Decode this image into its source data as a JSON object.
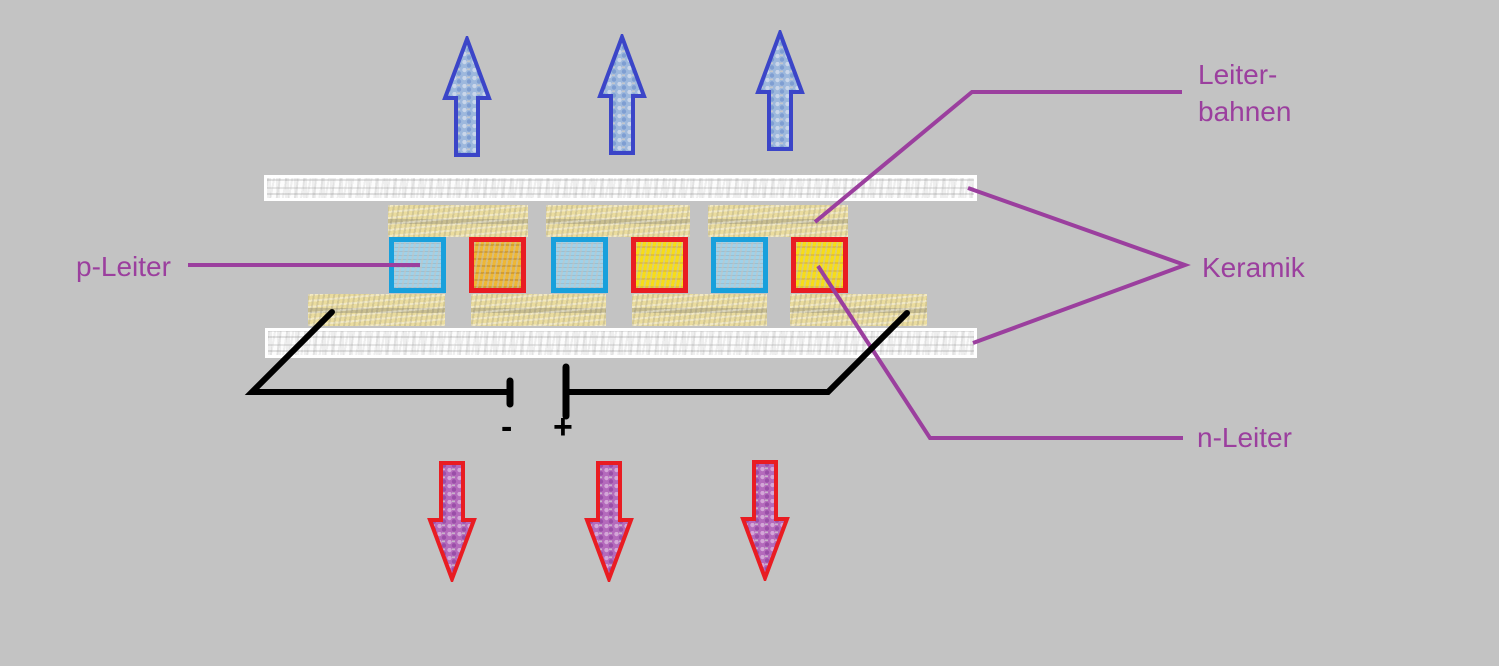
{
  "labels": {
    "leiterbahnen_line1": "Leiter-",
    "leiterbahnen_line2": "bahnen",
    "keramik": "Keramik",
    "p_leiter": "p-Leiter",
    "n_leiter": "n-Leiter",
    "minus": "-",
    "plus": "+"
  },
  "diagram": {
    "type": "peltier-element-cross-section",
    "semiconductor_sequence": [
      "p",
      "n",
      "p",
      "n",
      "p",
      "n"
    ],
    "top_arrow_count": 3,
    "top_arrow_direction": "up",
    "bottom_arrow_count": 3,
    "bottom_arrow_direction": "down",
    "ceramic_plate_count": 2,
    "top_conductor_track_count": 3,
    "bottom_conductor_track_count": 4
  },
  "colors": {
    "background": "#c3c3c3",
    "label_text": "#9b3f9e",
    "leader_line": "#9b3f9e",
    "circuit_wire": "#000000",
    "ceramic_plate": "#fcfcfc",
    "conductor_track": "#eadc9e",
    "p_leiter_border": "#18a0dc",
    "p_leiter_fill": "#9fd2ea",
    "n_leiter_border": "#e91c22",
    "n_leiter_fill_yellow": "#f7dd17",
    "n_leiter_fill_orange": "#eeb735",
    "up_arrow_border": "#3b45c8",
    "up_arrow_fill": "#9db8dd",
    "down_arrow_border": "#e91c22",
    "down_arrow_fill": "#b46abc"
  }
}
